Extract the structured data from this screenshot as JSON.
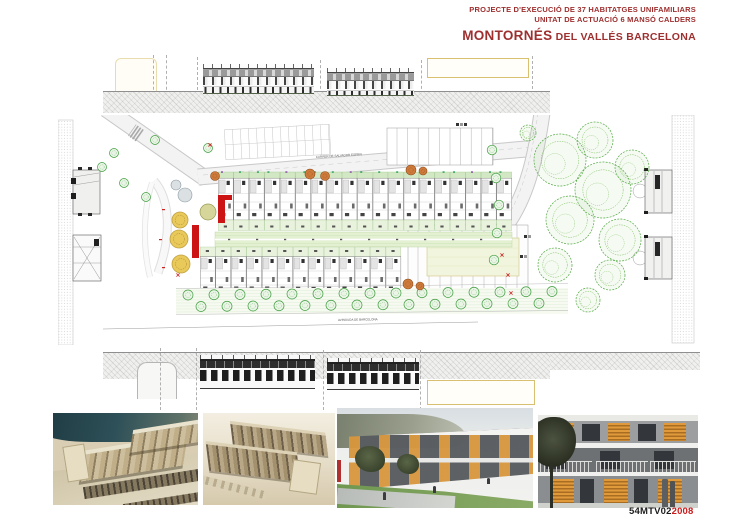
{
  "header": {
    "line1": "PROJECTE D'EXECUCIÓ DE 37 HABITATGES UNIFAMILIARS",
    "line2": "UNITAT DE ACTUACIÓ 6 MANSÓ CALDERS",
    "title": "MONTORNÉS",
    "title_suffix": " DEL VALLÉS BARCELONA"
  },
  "footer": {
    "project_code": "54MTV02",
    "year": "2008"
  },
  "site_plan": {
    "street_labels": {
      "top": "CARRER DE SALVADOR ESPRIU",
      "middle": "CARRER DE CAN BOSQUERONS",
      "bottom": "AVINGUDA DE BARCELONA"
    },
    "housing": {
      "top_row_units": 19,
      "bottom_row_units": 13
    },
    "avenue_trees_row1": 15,
    "avenue_trees_row2": 14
  },
  "colors": {
    "title_red": "#9e2f2f",
    "year_red": "#cc1a1a",
    "accent_red": "#cc1414",
    "tree_green": "#3f9c3f",
    "plaza_tree_yellow": "#e8c95a",
    "render_wood_orange": "#e09a3c"
  }
}
